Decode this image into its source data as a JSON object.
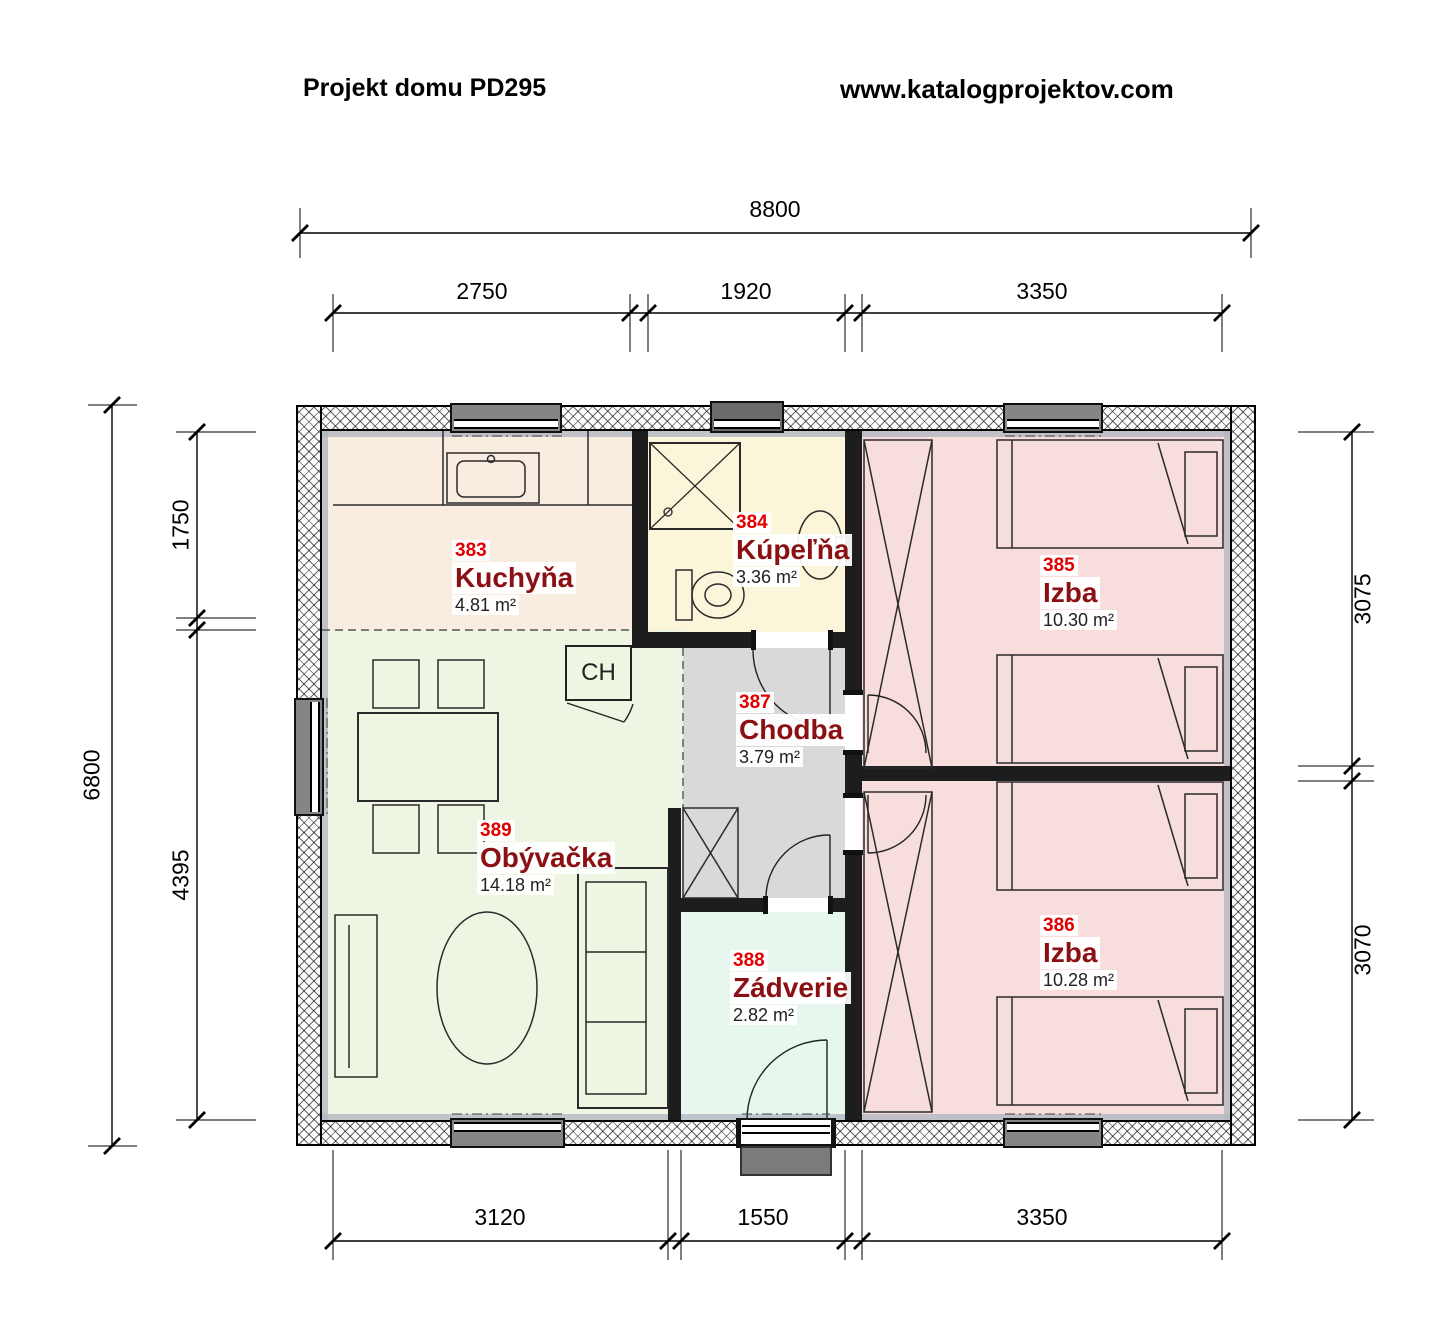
{
  "header": {
    "title": "Projekt domu PD295",
    "website": "www.katalogprojektov.com"
  },
  "dimensions": {
    "top": {
      "overall": "8800",
      "segments": [
        "2750",
        "1920",
        "3350"
      ]
    },
    "bottom": {
      "segments": [
        "3120",
        "1550",
        "3350"
      ]
    },
    "left": {
      "overall": "6800",
      "segments": [
        "1750",
        "4395"
      ]
    },
    "right": {
      "segments": [
        "3075",
        "3070"
      ]
    }
  },
  "rooms": [
    {
      "number": "383",
      "name": "Kuchyňa",
      "area": "4.81 m²"
    },
    {
      "number": "384",
      "name": "Kúpeľňa",
      "area": "3.36 m²"
    },
    {
      "number": "385",
      "name": "Izba",
      "area": "10.30 m²"
    },
    {
      "number": "386",
      "name": "Izba",
      "area": "10.28 m²"
    },
    {
      "number": "387",
      "name": "Chodba",
      "area": "3.79 m²"
    },
    {
      "number": "388",
      "name": "Zádverie",
      "area": "2.82 m²"
    },
    {
      "number": "389",
      "name": "Obývačka",
      "area": "14.18 m²"
    }
  ],
  "labels": {
    "fridge": "CH"
  },
  "colors": {
    "room_number": "#e10000",
    "room_name": "#8a1014",
    "kitchen_bg": "#f9ece0",
    "bathroom_bg": "#fbf6d9",
    "bedroom_bg": "#f8dddd",
    "hallway_bg": "#d9d9d9",
    "entry_bg": "#e7f7ee",
    "living_bg": "#eef5e2"
  }
}
